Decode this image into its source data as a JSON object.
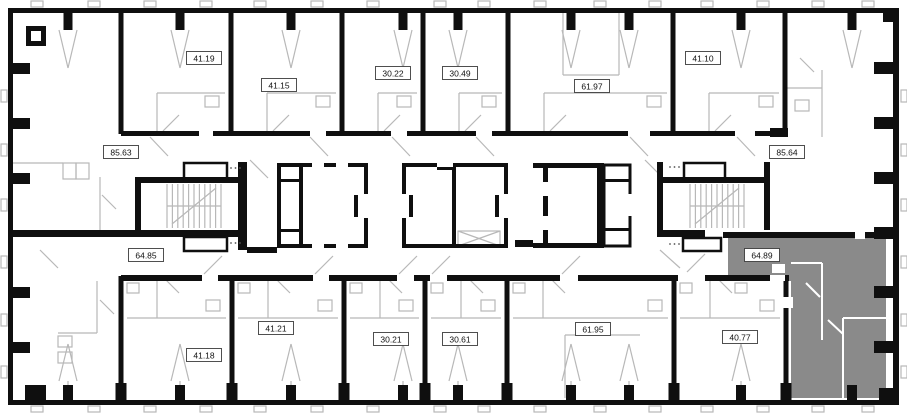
{
  "plan": {
    "selected_area": "64.89",
    "units": [
      {
        "area": "41.19",
        "x": 204,
        "y": 58,
        "row": "top",
        "highlighted": false
      },
      {
        "area": "41.15",
        "x": 279,
        "y": 85,
        "row": "top",
        "highlighted": false
      },
      {
        "area": "30.22",
        "x": 393,
        "y": 73,
        "row": "top",
        "highlighted": false
      },
      {
        "area": "30.49",
        "x": 460,
        "y": 73,
        "row": "top",
        "highlighted": false
      },
      {
        "area": "61.97",
        "x": 592,
        "y": 86,
        "row": "top",
        "highlighted": false
      },
      {
        "area": "41.10",
        "x": 703,
        "y": 58,
        "row": "top",
        "highlighted": false
      },
      {
        "area": "85.63",
        "x": 121,
        "y": 152,
        "row": "middle",
        "highlighted": false
      },
      {
        "area": "85.64",
        "x": 787,
        "y": 152,
        "row": "middle",
        "highlighted": false
      },
      {
        "area": "64.85",
        "x": 146,
        "y": 255,
        "row": "middle",
        "highlighted": false
      },
      {
        "area": "64.89",
        "x": 762,
        "y": 255,
        "row": "middle",
        "highlighted": true
      },
      {
        "area": "41.18",
        "x": 204,
        "y": 355,
        "row": "bottom",
        "highlighted": false
      },
      {
        "area": "41.21",
        "x": 276,
        "y": 328,
        "row": "bottom",
        "highlighted": false
      },
      {
        "area": "30.21",
        "x": 391,
        "y": 339,
        "row": "bottom",
        "highlighted": false
      },
      {
        "area": "30.61",
        "x": 460,
        "y": 339,
        "row": "bottom",
        "highlighted": false
      },
      {
        "area": "61.95",
        "x": 593,
        "y": 329,
        "row": "bottom",
        "highlighted": false
      },
      {
        "area": "40.77",
        "x": 740,
        "y": 337,
        "row": "bottom",
        "highlighted": false
      }
    ],
    "colors": {
      "background": "#ffffff",
      "wall": "#0f0f0f",
      "partition": "#b8b8b8",
      "highlight": "#8a8a8a",
      "label_bg": "#ffffff",
      "label_border": "#3c3c3c",
      "label_text": "#111111",
      "dots": "#555555"
    }
  }
}
